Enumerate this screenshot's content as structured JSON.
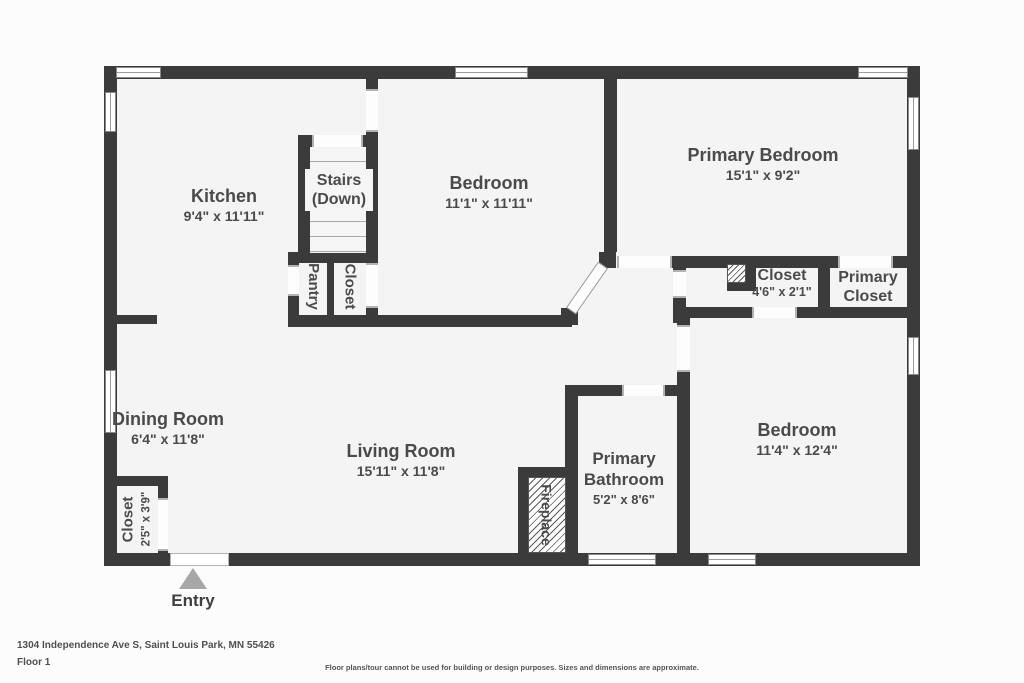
{
  "colors": {
    "wall": "#3b3b3b",
    "room_fill": "#f4f4f4",
    "label_text": "#4a4a4a",
    "entry_arrow": "#a7a7a7"
  },
  "plan": {
    "entry_label": "Entry",
    "rooms": {
      "kitchen": {
        "name": "Kitchen",
        "dims": "9'4\" x 11'11\""
      },
      "stairs": {
        "line1": "Stairs",
        "line2": "(Down)"
      },
      "bedroom_top": {
        "name": "Bedroom",
        "dims": "11'1\" x 11'11\""
      },
      "primary_bedroom": {
        "name": "Primary Bedroom",
        "dims": "15'1\" x 9'2\""
      },
      "pantry": {
        "name": "Pantry"
      },
      "stairs_closet": {
        "name": "Closet"
      },
      "hall_closet": {
        "name": "Closet",
        "dims": "4'6\" x 2'1\""
      },
      "primary_closet": {
        "line1": "Primary",
        "line2": "Closet"
      },
      "dining_room": {
        "name": "Dining Room",
        "dims": "6'4\" x 11'8\""
      },
      "living_room": {
        "name": "Living Room",
        "dims": "15'11\" x 11'8\""
      },
      "primary_bathroom": {
        "line1": "Primary",
        "line2": "Bathroom",
        "dims": "5'2\" x 8'6\""
      },
      "bedroom_bottom": {
        "name": "Bedroom",
        "dims": "11'4\" x 12'4\""
      },
      "fireplace": {
        "name": "Fireplace"
      },
      "entry_closet": {
        "name": "Closet",
        "dims": "2'5\" x 3'9\""
      }
    }
  },
  "footer": {
    "address": "1304 Independence Ave S, Saint Louis Park, MN 55426",
    "floor": "Floor 1",
    "disclaimer": "Floor plans/tour cannot be used for building or design purposes. Sizes and dimensions are approximate."
  }
}
